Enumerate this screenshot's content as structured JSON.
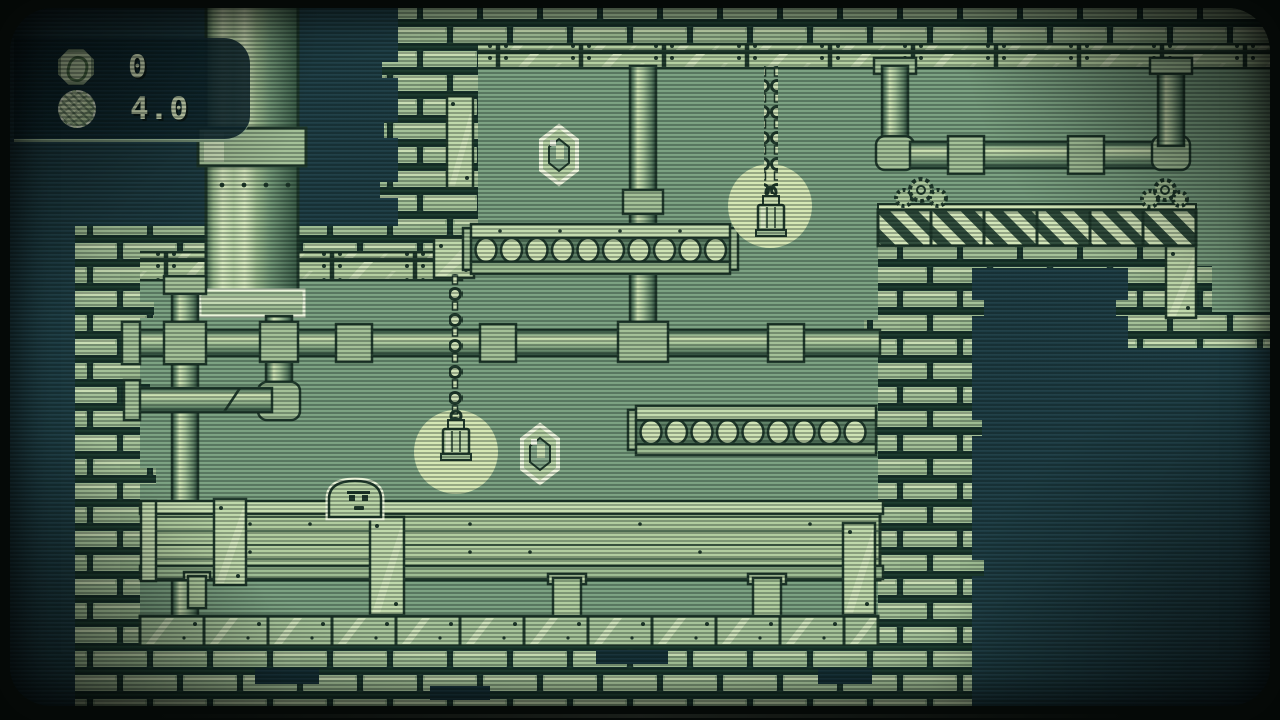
{
  "window": {
    "type": "crt-game-screen"
  },
  "hud": {
    "coin_counter": {
      "icon": "coin-icon",
      "value": "0"
    },
    "bomb_timer": {
      "icon": "bomb-icon",
      "value": "4.0"
    }
  },
  "level": {
    "player": "slime-blob",
    "gems_visible": 2,
    "hanging_lamps": 2,
    "roller_platforms": 2,
    "hazard_bridge_segments": 6
  },
  "palette": {
    "bezel": "#040806",
    "screen_bg": "#1d3c44",
    "screen_bg_dark": "#142e35",
    "field": "#7ba181",
    "field_dark": "#6d9173",
    "light": "#cfe3b4",
    "lighter": "#e2efcc",
    "mid": "#a3c097",
    "mid_dark": "#84a483",
    "shadow": "#4e7259",
    "outline": "#1d3629",
    "glow": "#dcedb9",
    "hud_panel": "#132f38",
    "hud_text": "#dcebc3"
  }
}
